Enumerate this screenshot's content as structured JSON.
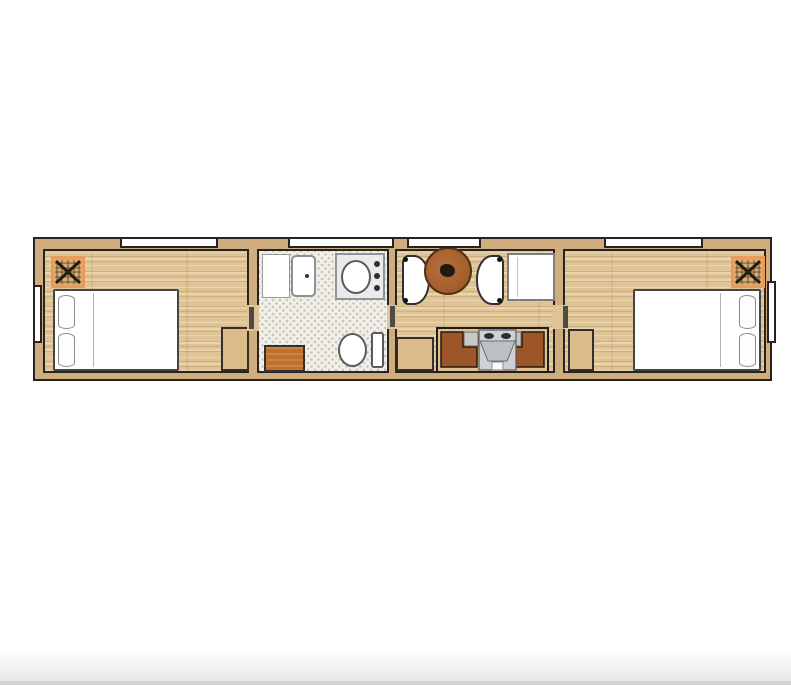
{
  "app": {
    "type": "floor-plan-illustration",
    "background": "#ffffff"
  },
  "palette": {
    "outline": "#262321",
    "wall_fill": "#cfad7f",
    "wood_floor": "#e0c493",
    "tile_floor": "#f2efe9",
    "vent_border": "#ec9a59",
    "vent_fill": "#d9ae6e",
    "bench_brown": "#9c5628",
    "cabinet_tan": "#dcbc8a",
    "cabinet_orange": "#c0702c",
    "stove_gray": "#ced1d5",
    "fixture_white": "#ffffff",
    "table_brown": "#a4602e"
  },
  "floorplan": {
    "layout": "long-narrow-container-home, horizontal",
    "rooms": [
      {
        "id": "bedroom-left",
        "floor": "wood",
        "fixtures": [
          "ceiling-vent",
          "double-bed",
          "two-pillows",
          "cabinet",
          "top-window",
          "left-wall-window",
          "door-to-bathroom"
        ]
      },
      {
        "id": "bathroom",
        "floor": "penny-tile",
        "fixtures": [
          "shower-pan",
          "washer-unit",
          "sink-vanity",
          "toilet",
          "orange-cabinet",
          "top-window"
        ]
      },
      {
        "id": "living-dining",
        "floor": "wood",
        "fixtures": [
          "booth-seat-left",
          "booth-seat-right",
          "round-table",
          "refrigerator",
          "tan-cabinet",
          "u-shaped-bench-seating",
          "stove-fireplace",
          "top-window"
        ]
      },
      {
        "id": "bedroom-right",
        "floor": "wood",
        "fixtures": [
          "ceiling-vent",
          "double-bed",
          "two-pillows",
          "cabinet",
          "top-window",
          "right-wall-window",
          "door-to-living"
        ]
      }
    ],
    "windows": {
      "top_wall": 4,
      "left_wall": 1,
      "right_wall": 1
    },
    "doors": 3,
    "vents": 2,
    "beds": 2
  },
  "footer": {
    "style": "light-gray-gradient-bar"
  }
}
